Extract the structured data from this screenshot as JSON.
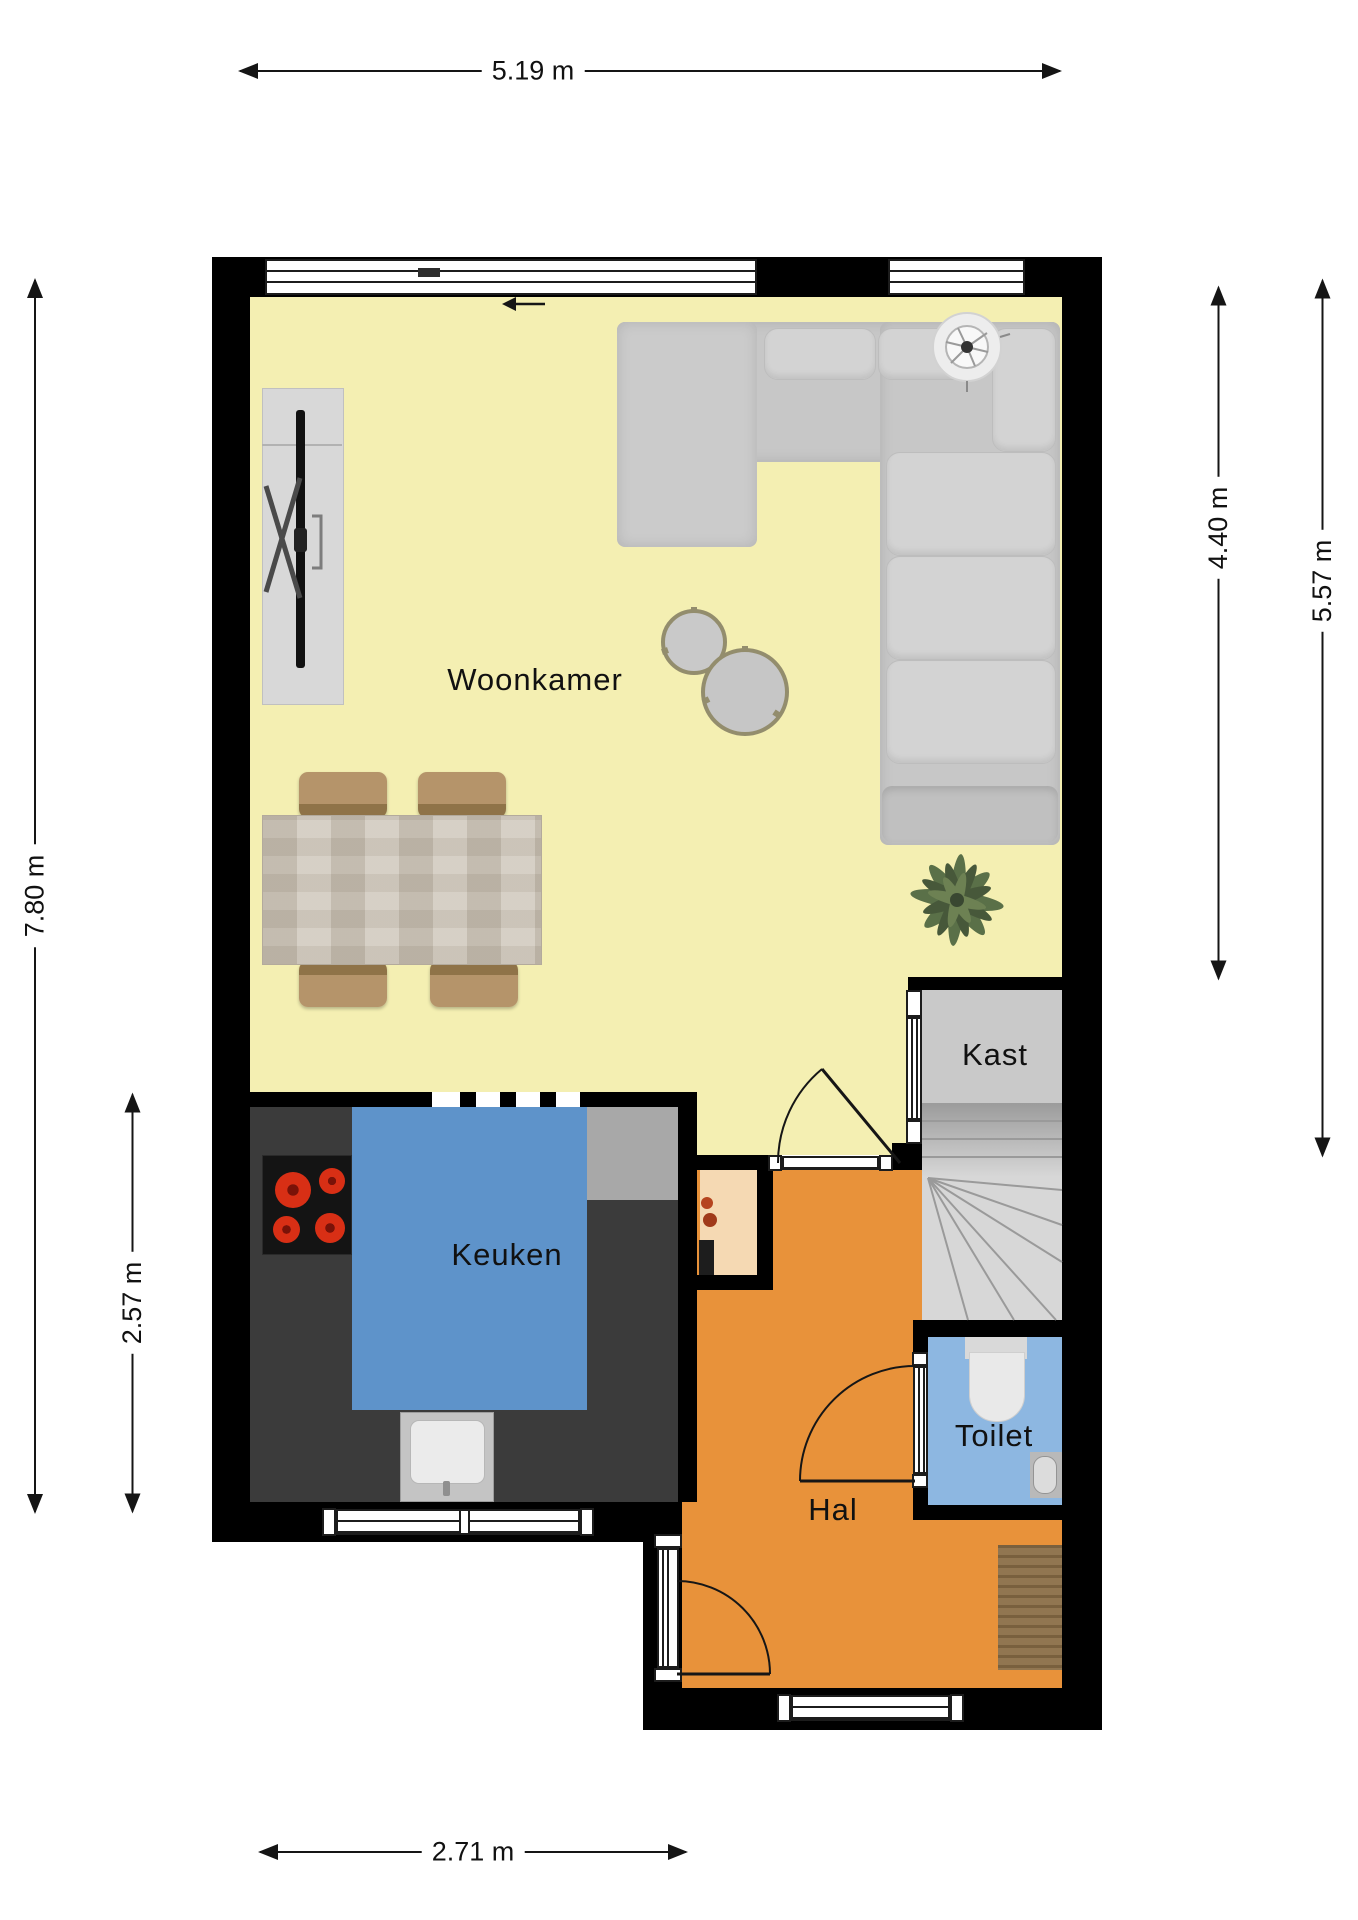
{
  "plan": {
    "rooms": {
      "woonkamer": {
        "label": "Woonkamer",
        "color": "#f4efb2"
      },
      "keuken": {
        "label": "Keuken",
        "color": "#5e93ca"
      },
      "hal": {
        "label": "Hal",
        "color": "#e8923a"
      },
      "kast": {
        "label": "Kast",
        "color": "#c9c9c9"
      },
      "toilet": {
        "label": "Toilet",
        "color": "#8db7e1"
      },
      "alcove": {
        "color": "#f5d9b3"
      },
      "stairs": {
        "color": "#d7d7d7"
      }
    },
    "dimensions": {
      "top": "5.19 m",
      "left_total": "7.80 m",
      "left_kitchen": "2.57 m",
      "right_inner": "4.40 m",
      "right_outer": "5.57 m",
      "bottom": "2.71 m"
    },
    "colors": {
      "wall": "#000000",
      "dimension_ink": "#151515",
      "counter_dark": "#3b3b3b",
      "counter_light": "#a8a8a8",
      "sofa": "#c7c7c7",
      "table_stone": "#cdc5b8",
      "chair_tan": "#b5946a",
      "mat_wood": "#8a6d46",
      "plant_green": "#5a7048"
    }
  }
}
